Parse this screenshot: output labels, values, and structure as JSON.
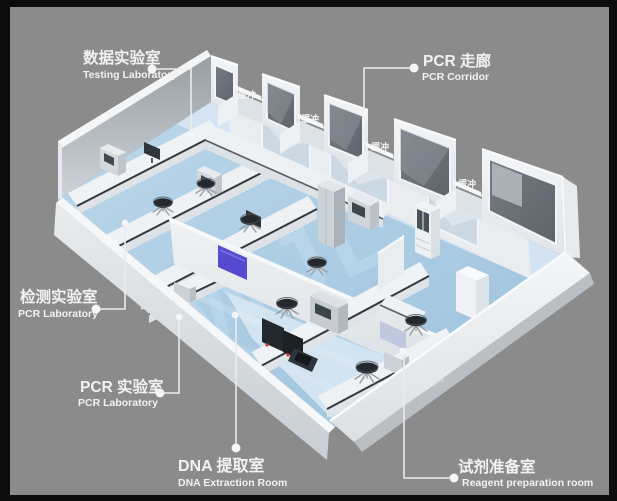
{
  "illustration": {
    "type": "3d-lab-floorplan-render",
    "watermark_text": "WJL"
  },
  "colors": {
    "frame": "#0c0c0c",
    "background": "#8b8b8b",
    "floor": "#a9cbe4",
    "floor_light": "#d7e5f2",
    "wall": "#eef1f4",
    "wall_shadow": "#ced4d9",
    "window_dark": "#6a7178",
    "glass_light": "#ccd8e2",
    "accent_purple": "#564bd0",
    "counter_dark": "#32383e",
    "stool_dark": "#25292e",
    "callout": "#f2f2f2",
    "watermark": "#c7e0f5"
  },
  "callouts": {
    "testing_lab": {
      "title": "数据实验室",
      "subtitle": "Testing Laboratory"
    },
    "pcr_corridor": {
      "title": "PCR 走廊",
      "subtitle": "PCR Corridor"
    },
    "detection_lab": {
      "title": "检测实验室",
      "subtitle": "PCR Laboratory"
    },
    "pcr_lab": {
      "title": "PCR 实验室",
      "subtitle": "PCR Laboratory"
    },
    "dna_extraction": {
      "title": "DNA 提取室",
      "subtitle": "DNA Extraction Room"
    },
    "reagent_prep": {
      "title": "试剂准备室",
      "subtitle": "Reagent preparation room"
    }
  },
  "buffer_room_label": "缓冲"
}
